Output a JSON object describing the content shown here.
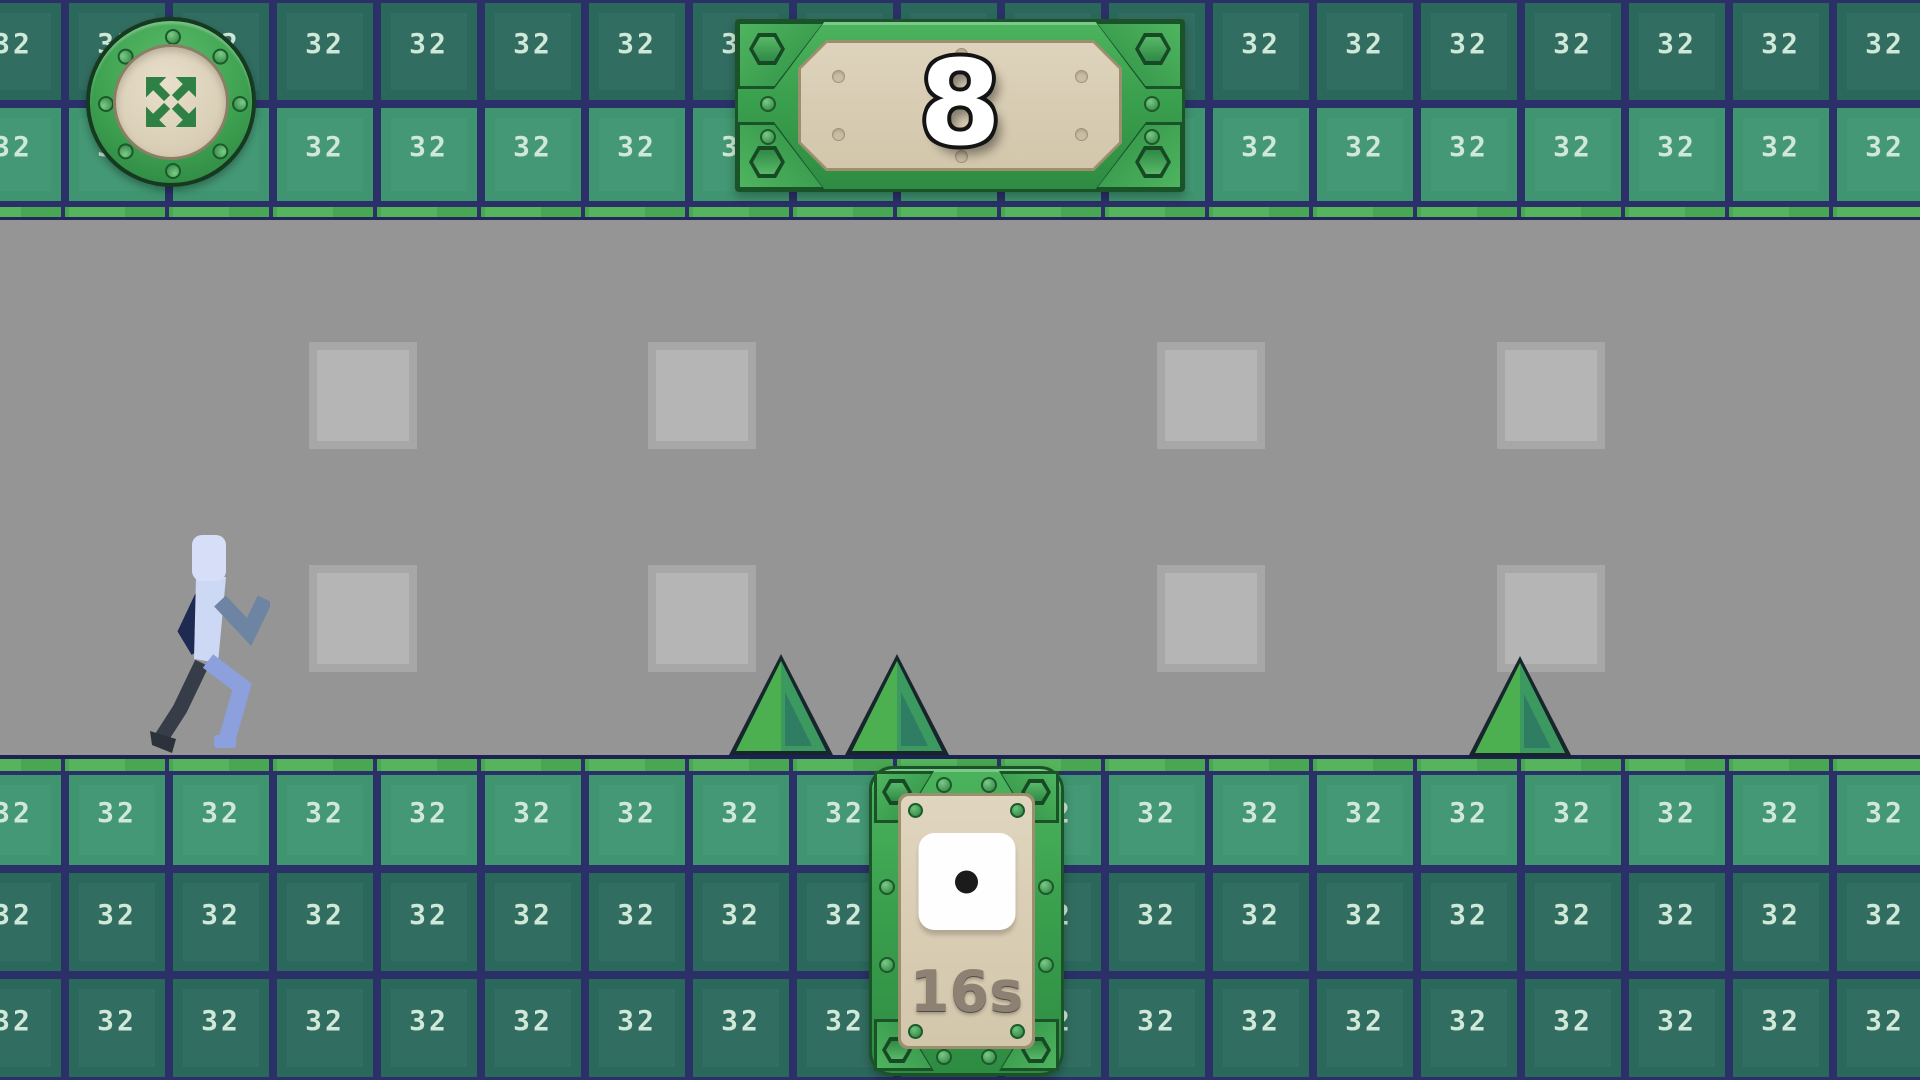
{
  "hud": {
    "score_panel": {
      "value": "8"
    },
    "dice_panel": {
      "die_value": 1,
      "timer": "16s"
    },
    "fullscreen_button": {
      "icon": "fullscreen-expand-arrows"
    }
  },
  "tiles": {
    "label": "32"
  },
  "sprites": {
    "player": "pixel-runner-blue",
    "spike_count": 3,
    "ghost_square_count": 8
  },
  "colors": {
    "grout_navy": "#2b3068",
    "tile_dark_teal": "#2b685c",
    "tile_light_green": "#3e9570",
    "tile_label_mint": "#cfe8d6",
    "edge_grass_green": "#55b45c",
    "play_area_gray": "#959595",
    "ghost_square_gray": "#b5b5b5",
    "spike_green": "#4caf50",
    "frame_green": "#3aa04e",
    "frame_outline_green": "#1b5329",
    "panel_cream": "#d7ccb3",
    "score_white": "#ffffff",
    "timer_taupe": "#8c8173",
    "die_white": "#fefefe",
    "pip_black": "#1b1b1b"
  }
}
